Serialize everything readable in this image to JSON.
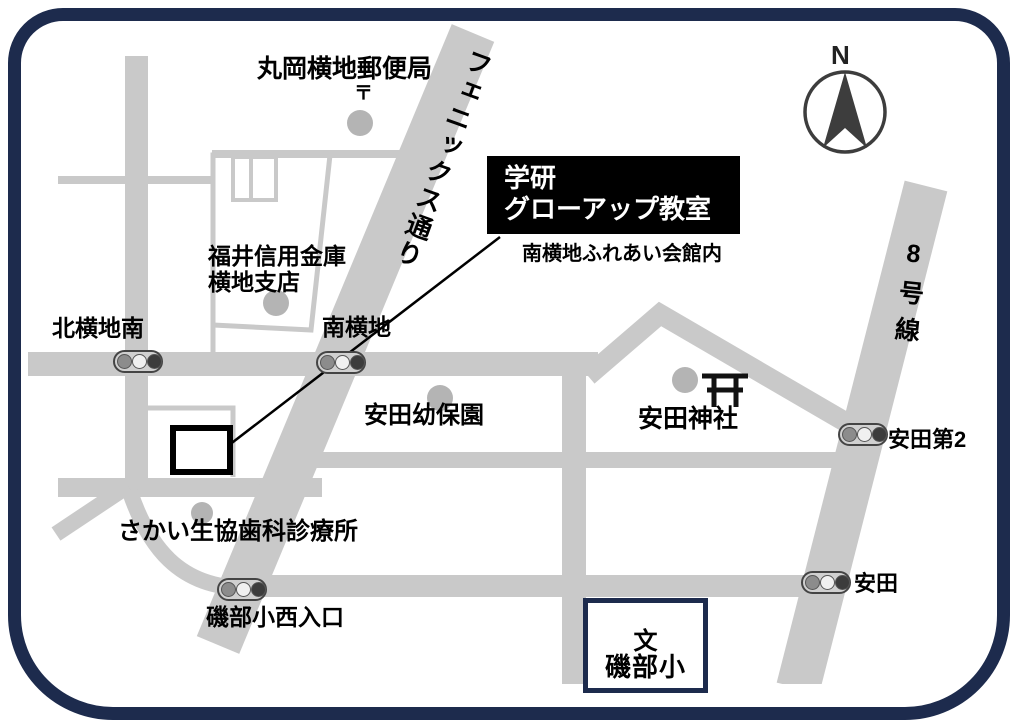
{
  "map": {
    "colors": {
      "frame": "#1d2b4d",
      "road": "#c9c9c9",
      "poi_dot": "#b4b4b4",
      "title_box_bg": "#000000",
      "title_box_text": "#ffffff"
    },
    "compass": {
      "label": "N"
    },
    "destination": {
      "name_line1": "学研",
      "name_line2": "グローアップ教室",
      "building": "南横地ふれあい会館内"
    },
    "streets": {
      "phoenix": "フェニックス通り",
      "route8": "8号線"
    },
    "places": {
      "post_office": {
        "name": "丸岡横地郵便局",
        "mark": "〒"
      },
      "bank": {
        "name_line1": "福井信用金庫",
        "name_line2": "横地支店"
      },
      "kindergarten": {
        "name": "安田幼保園"
      },
      "shrine": {
        "name": "安田神社"
      },
      "dental": {
        "name": "さかい生協歯科診療所"
      },
      "school": {
        "name": "磯部小",
        "school_mark": "文"
      }
    },
    "intersections": {
      "kitayokoji_minami": "北横地南",
      "minami_yokoji": "南横地",
      "yasuda_dai2": "安田第2",
      "yasuda": "安田",
      "isobe_shonishi_iriguchi": "磯部小西入口"
    }
  }
}
